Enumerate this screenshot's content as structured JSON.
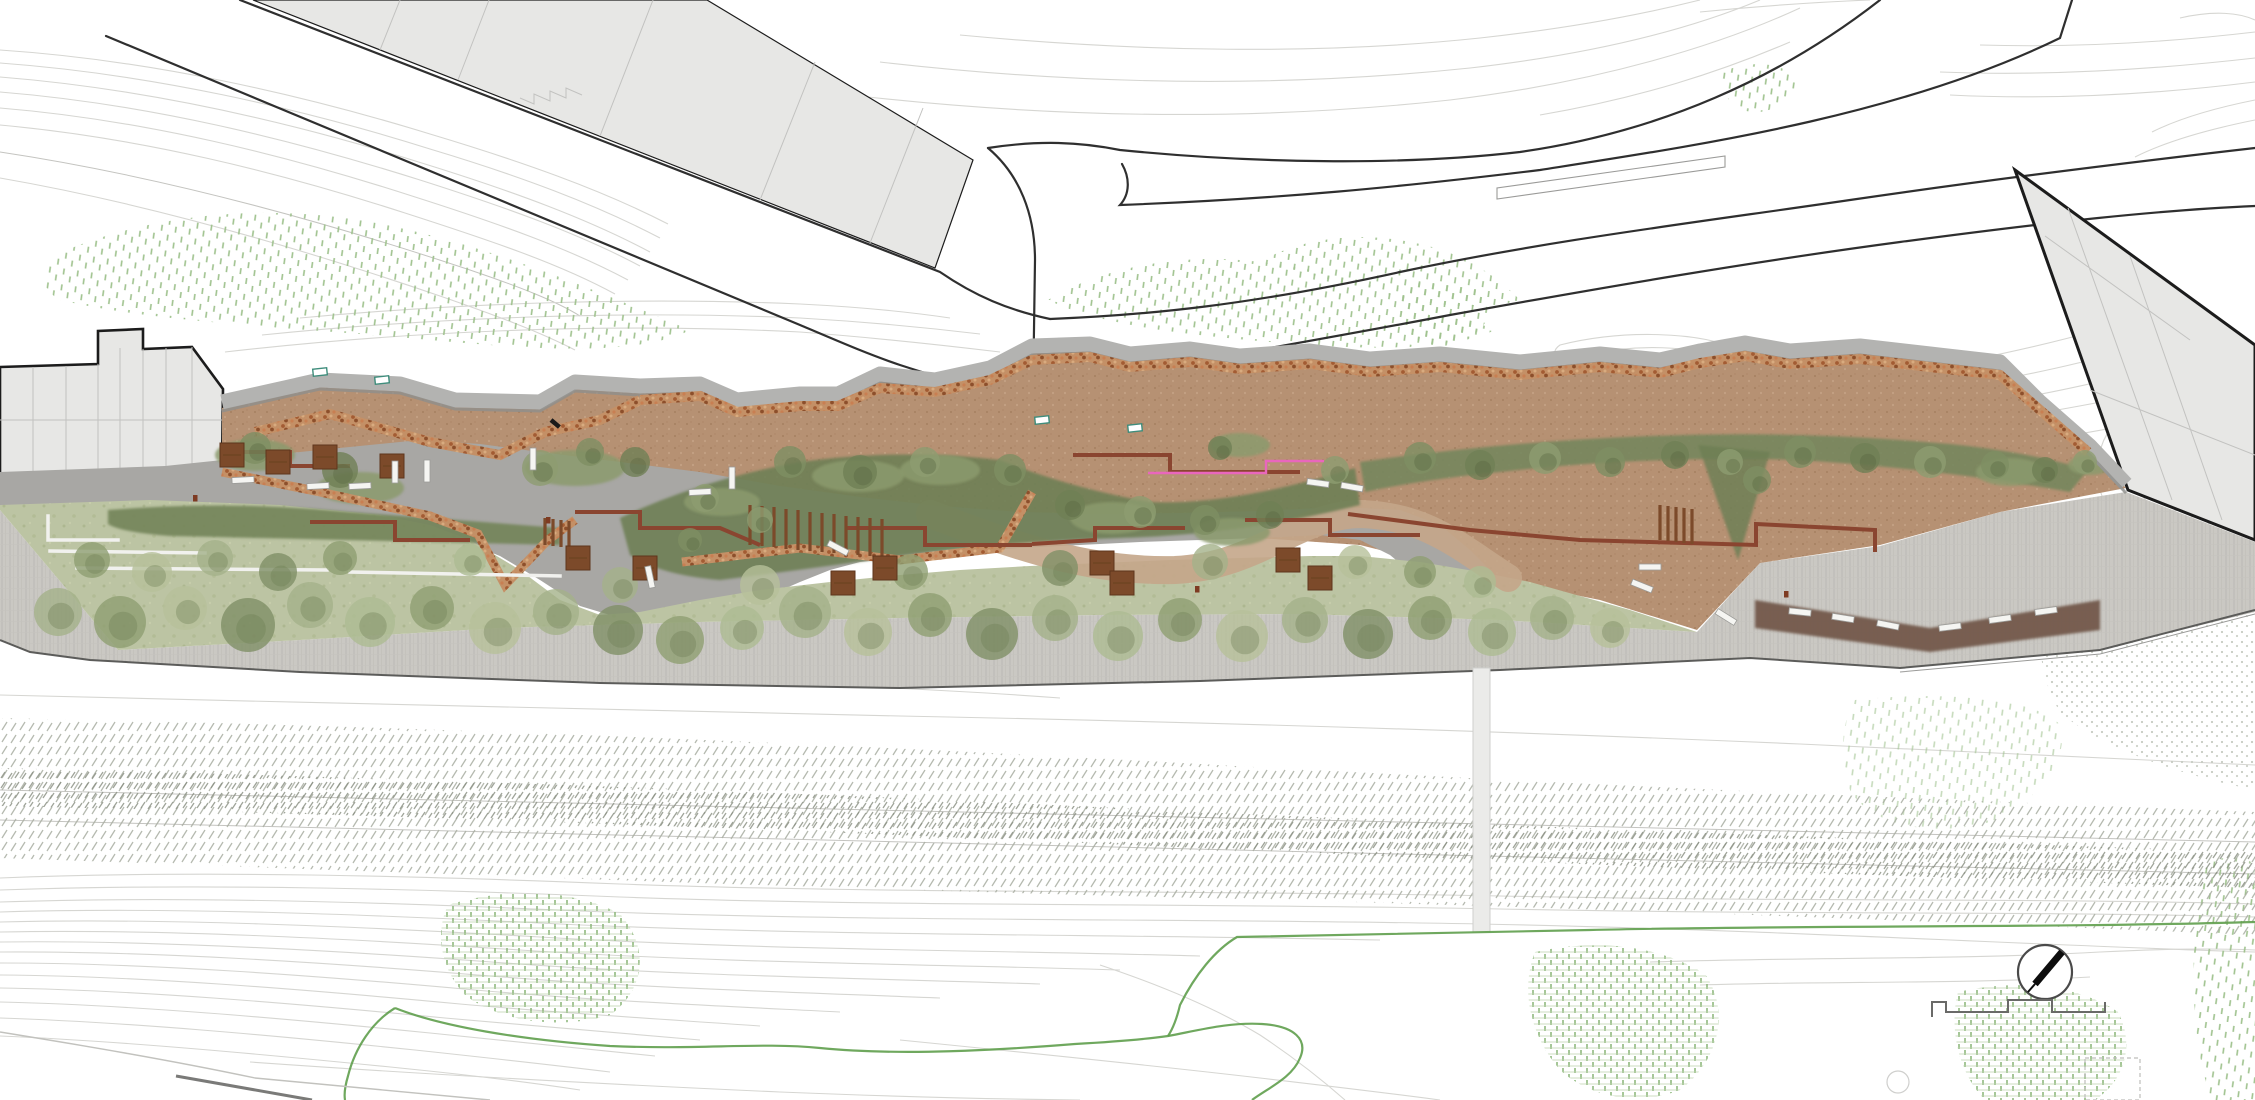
{
  "meta": {
    "title": "Linear park landscape master plan - site plan rendering",
    "drawing_type": "architectural landscape site plan, top view, no text labels",
    "orientation_note": "north arrow compass at bottom right pointing upper-right"
  },
  "palette": {
    "bg": "#ffffff",
    "contour": "#d6d6d2",
    "contour2": "#c4c4c0",
    "road-line": "#2f2f2f",
    "building-fill": "#e7e7e5",
    "building-outline": "#1c1c1c",
    "parcel": "#c2c2c0",
    "band": "#b3b3b1",
    "band-shadow": "#8e8e8c",
    "corten": "#8a4530",
    "terrace": "#b69173",
    "road-gray": "#a8a7a4",
    "lawn": "#bcc4a3",
    "shrub": "#74845a",
    "prom": "#cac8c3",
    "wood": "#7c4a2a",
    "bench": "#f5f5f2",
    "pink": "#e966bd",
    "green-line": "#5f9e4d",
    "teal": "#3f8d7c",
    "bed": "#72594b",
    "veg": "#9fc28e",
    "rail": "#a9aea2",
    "rail-dark": "#878d80",
    "gabion-base": "#c49066",
    "path-tan": "#c4a68a"
  },
  "elements": {
    "upper_left_building": "long rotated building slab above diagonal street",
    "left_block": "existing town block at left edge with thick outline",
    "right_building": "rotated building at right edge with thick outline",
    "park": "linear terraced park with gabion walls, corten steps, lawn and promenade",
    "rail_corridor": "diagonal-hatched railway corridor below promenade",
    "compass": "north arrow circle, bottom right",
    "footprint_line": "stepped building outline fragment, bottom right"
  },
  "trees_lawn": {
    "tones": [
      "#a4b289",
      "#8e9f72",
      "#b6c09a",
      "#7f9066",
      "#adbb92"
    ],
    "shadow": "#6c7c52",
    "items": [
      [
        58,
        612,
        24,
        0
      ],
      [
        120,
        622,
        26,
        1
      ],
      [
        185,
        608,
        22,
        2
      ],
      [
        248,
        625,
        27,
        3
      ],
      [
        310,
        605,
        23,
        0
      ],
      [
        370,
        622,
        25,
        4
      ],
      [
        432,
        608,
        22,
        1
      ],
      [
        495,
        628,
        26,
        2
      ],
      [
        556,
        612,
        23,
        0
      ],
      [
        618,
        630,
        25,
        3
      ],
      [
        680,
        640,
        24,
        1
      ],
      [
        742,
        628,
        22,
        4
      ],
      [
        805,
        612,
        26,
        0
      ],
      [
        868,
        632,
        24,
        2
      ],
      [
        930,
        615,
        22,
        1
      ],
      [
        992,
        634,
        26,
        3
      ],
      [
        1055,
        618,
        23,
        0
      ],
      [
        1118,
        636,
        25,
        4
      ],
      [
        1180,
        620,
        22,
        1
      ],
      [
        1242,
        636,
        26,
        2
      ],
      [
        1305,
        620,
        23,
        0
      ],
      [
        1368,
        634,
        25,
        3
      ],
      [
        1430,
        618,
        22,
        1
      ],
      [
        1492,
        632,
        24,
        4
      ],
      [
        1552,
        618,
        22,
        0
      ],
      [
        1610,
        628,
        20,
        2
      ],
      [
        92,
        560,
        18,
        1
      ],
      [
        152,
        572,
        20,
        2
      ],
      [
        215,
        558,
        18,
        0
      ],
      [
        278,
        572,
        19,
        3
      ],
      [
        340,
        558,
        17,
        1
      ],
      [
        470,
        560,
        16,
        4
      ],
      [
        620,
        585,
        18,
        0
      ],
      [
        760,
        585,
        20,
        2
      ],
      [
        910,
        572,
        18,
        1
      ],
      [
        1060,
        568,
        18,
        3
      ],
      [
        1210,
        562,
        18,
        0
      ],
      [
        1355,
        562,
        17,
        2
      ],
      [
        1420,
        572,
        16,
        1
      ],
      [
        1480,
        582,
        16,
        4
      ]
    ]
  },
  "trees_terrace": {
    "tones": [
      "#7e8f63",
      "#6f8055",
      "#8d9c70"
    ],
    "shadow": "#55633e",
    "items": [
      [
        255,
        448,
        16,
        0
      ],
      [
        340,
        470,
        18,
        1
      ],
      [
        540,
        468,
        18,
        2
      ],
      [
        590,
        452,
        14,
        0
      ],
      [
        635,
        462,
        15,
        1
      ],
      [
        705,
        498,
        14,
        2
      ],
      [
        790,
        462,
        16,
        0
      ],
      [
        860,
        472,
        17,
        1
      ],
      [
        925,
        462,
        15,
        2
      ],
      [
        1010,
        470,
        16,
        0
      ],
      [
        1070,
        505,
        15,
        1
      ],
      [
        1140,
        512,
        16,
        2
      ],
      [
        1205,
        520,
        15,
        0
      ],
      [
        1270,
        515,
        14,
        1
      ],
      [
        1335,
        470,
        14,
        2
      ],
      [
        1420,
        458,
        16,
        0
      ],
      [
        1480,
        465,
        15,
        1
      ],
      [
        1545,
        458,
        16,
        2
      ],
      [
        1610,
        462,
        15,
        0
      ],
      [
        1675,
        455,
        14,
        1
      ],
      [
        1730,
        462,
        13,
        2
      ],
      [
        1800,
        452,
        16,
        0
      ],
      [
        1865,
        458,
        15,
        1
      ],
      [
        1930,
        462,
        16,
        2
      ],
      [
        1995,
        465,
        14,
        0
      ],
      [
        2045,
        470,
        13,
        1
      ],
      [
        2085,
        462,
        12,
        2
      ],
      [
        1757,
        480,
        14,
        0
      ],
      [
        1220,
        448,
        12,
        1
      ],
      [
        760,
        520,
        13,
        2
      ],
      [
        690,
        540,
        12,
        0
      ]
    ]
  },
  "shrub_pockets": [
    [
      255,
      455,
      40,
      16
    ],
    [
      360,
      488,
      44,
      16
    ],
    [
      575,
      468,
      50,
      18
    ],
    [
      722,
      502,
      38,
      14
    ],
    [
      858,
      476,
      46,
      16
    ],
    [
      1112,
      518,
      42,
      16
    ],
    [
      1232,
      532,
      38,
      14
    ],
    [
      940,
      470,
      40,
      15
    ],
    [
      1240,
      445,
      30,
      12
    ],
    [
      2010,
      472,
      34,
      14
    ],
    [
      2090,
      465,
      22,
      10
    ]
  ],
  "benches": [
    [
      243,
      480,
      -3
    ],
    [
      318,
      486,
      -3
    ],
    [
      360,
      486,
      -3
    ],
    [
      395,
      472,
      90
    ],
    [
      427,
      471,
      90
    ],
    [
      533,
      459,
      90
    ],
    [
      650,
      577,
      78
    ],
    [
      700,
      492,
      -3
    ],
    [
      732,
      478,
      90
    ],
    [
      838,
      548,
      28
    ],
    [
      1318,
      483,
      8
    ],
    [
      1352,
      487,
      10
    ],
    [
      1650,
      567,
      0
    ],
    [
      1642,
      586,
      22
    ],
    [
      1726,
      617,
      32
    ],
    [
      1800,
      612,
      6
    ],
    [
      1843,
      618,
      9
    ],
    [
      1888,
      625,
      11
    ],
    [
      1950,
      627,
      -7
    ],
    [
      2000,
      619,
      -8
    ],
    [
      2046,
      611,
      -8
    ]
  ],
  "wood_decks": [
    [
      232,
      455
    ],
    [
      278,
      462
    ],
    [
      325,
      457
    ],
    [
      392,
      466
    ],
    [
      578,
      558
    ],
    [
      645,
      568
    ],
    [
      843,
      583
    ],
    [
      885,
      568
    ],
    [
      1102,
      563
    ],
    [
      1122,
      583
    ],
    [
      1288,
      560
    ],
    [
      1320,
      578
    ]
  ],
  "red_dots": [
    [
      195,
      498
    ],
    [
      548,
      520
    ],
    [
      1197,
      589
    ],
    [
      1786,
      594
    ]
  ],
  "teal_markers": [
    [
      320,
      372
    ],
    [
      382,
      380
    ],
    [
      1042,
      420
    ],
    [
      1135,
      428
    ]
  ]
}
